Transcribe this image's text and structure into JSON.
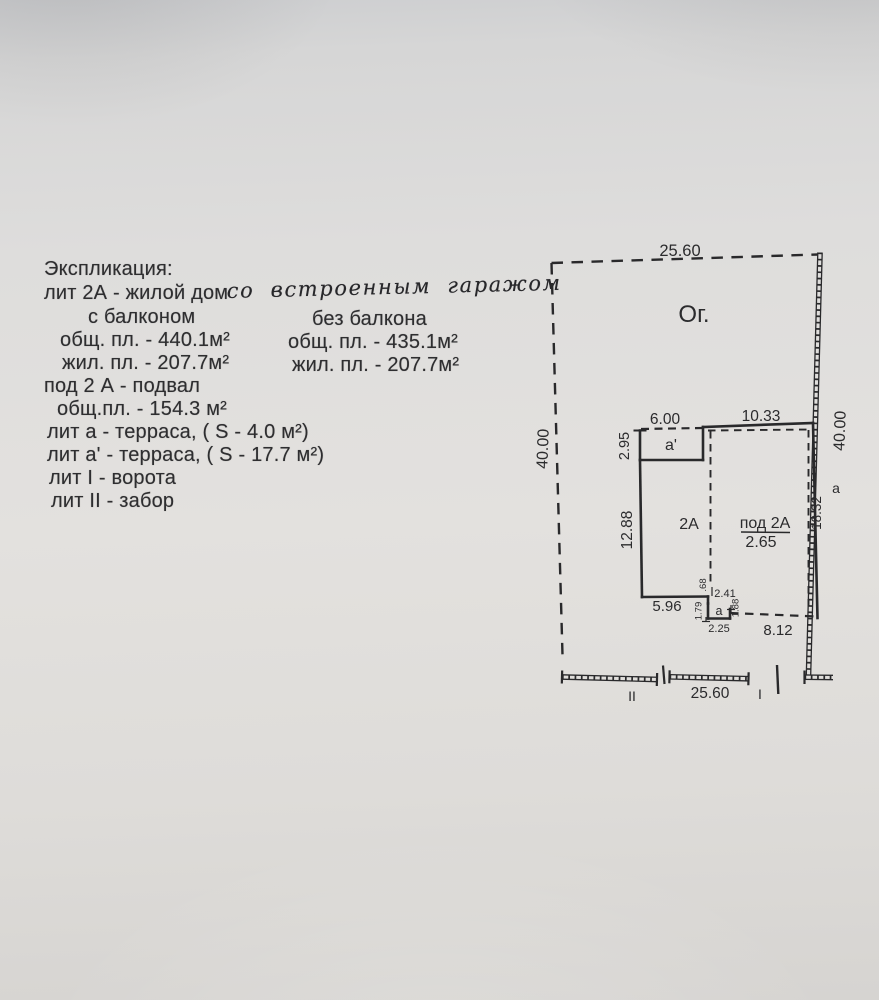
{
  "paper": {
    "background": "#dedddb",
    "ink": "#2b2b2d"
  },
  "explication": {
    "title": "Экспликация:",
    "house_line_printed": "лит 2А - жилой дом",
    "house_line_handwritten": "со встроенным гаражом",
    "with_balcony_header": "с балконом",
    "without_balcony_header": "без балкона",
    "with_balcony_total": "общ. пл. - 440.1м²",
    "without_balcony_total": "общ. пл. - 435.1м²",
    "with_balcony_living": "жил. пл. - 207.7м²",
    "without_balcony_living": "жил. пл. - 207.7м²",
    "basement_line": "под 2 А - подвал",
    "basement_area": "общ.пл. - 154.3 м²",
    "terrace_a_line": "лит а - терраса, ( S - 4.0 м²)",
    "terrace_a1_line": "лит а' - терраса, ( S - 17.7 м²)",
    "gate_line": "лит I - ворота",
    "fence_line": "лит II - забор"
  },
  "plan": {
    "garden_label": "Ог.",
    "top_width": "25.60",
    "left_depth": "40.00",
    "right_depth": "40.00",
    "terrace_a1_width": "6.00",
    "house_top_width": "10.33",
    "terrace_a1_depth": "2.95",
    "terrace_a1_label": "а'",
    "house_left_wall": "12.88",
    "house_label": "2А",
    "basement_label": "под 2А",
    "basement_height": "2.65",
    "house_right_wall": "18.32",
    "side_label_a": "а",
    "step_depth": ".68",
    "porch_top_width": "2.41",
    "terrace_a_left": "1.79",
    "terrace_a_label": "а",
    "terrace_a_right": "1.88",
    "terrace_a_width": "2.25",
    "house_bottom_left": "5.96",
    "house_bottom_right": "8.12",
    "bottom_width": "25.60",
    "fence_mark": "II",
    "gate_mark": "I"
  }
}
